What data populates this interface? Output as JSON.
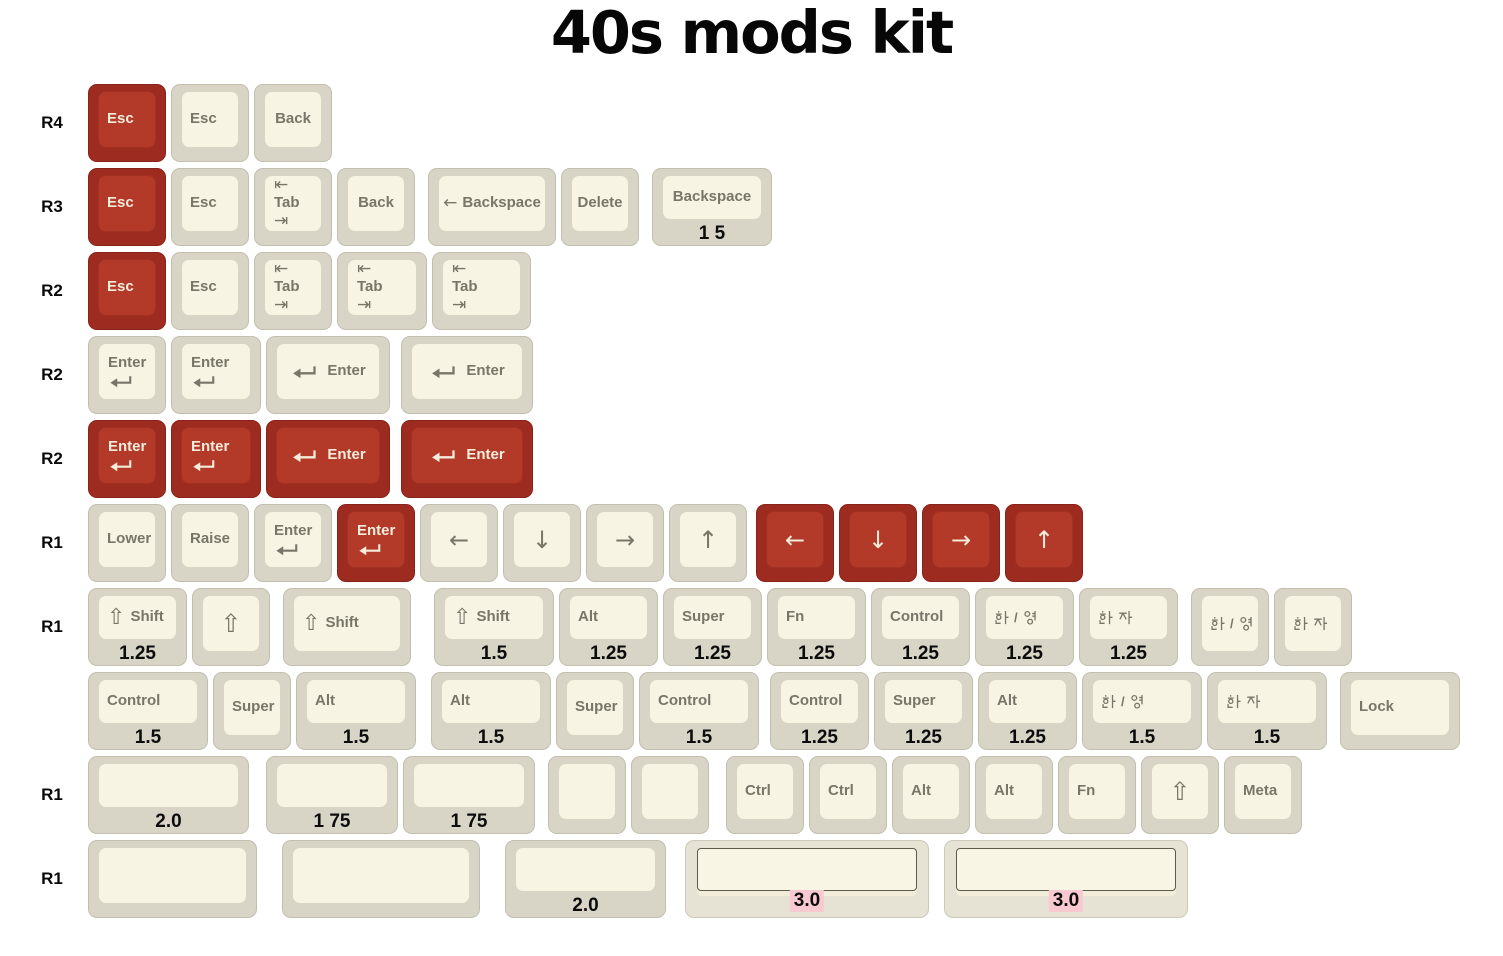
{
  "title": "40s mods kit",
  "colors": {
    "red_base": "#9d2b20",
    "red_top": "#b33a29",
    "cream_base": "#d8d5c7",
    "cream_top": "#f8f4e3",
    "legend_grey": "#787669",
    "legend_cream": "#f5ecdb",
    "size_label_black": "#0c0c0c",
    "size_highlight_pink": "#f8c9d1"
  },
  "rows": [
    {
      "label": "R4",
      "keys": [
        {
          "kind": "text",
          "text": "Esc",
          "red": true
        },
        {
          "kind": "text",
          "text": "Esc"
        },
        {
          "kind": "text",
          "text": "Back",
          "center": true
        }
      ]
    },
    {
      "label": "R3",
      "keys": [
        {
          "kind": "text",
          "text": "Esc",
          "red": true
        },
        {
          "kind": "text",
          "text": "Esc"
        },
        {
          "kind": "tab",
          "text": "Tab"
        },
        {
          "kind": "text",
          "text": "Back",
          "center": true
        },
        {
          "kind": "bksp",
          "text": "Backspace",
          "w": 1.6,
          "gap": 8,
          "center": true
        },
        {
          "kind": "text",
          "text": "Delete",
          "center": true
        },
        {
          "kind": "text",
          "text": "Backspace",
          "w": 1.5,
          "gap": 8,
          "sub": "1 5",
          "center": true
        }
      ]
    },
    {
      "label": "R2",
      "keys": [
        {
          "kind": "text",
          "text": "Esc",
          "red": true
        },
        {
          "kind": "text",
          "text": "Esc"
        },
        {
          "kind": "tab",
          "text": "Tab"
        },
        {
          "kind": "tab",
          "text": "Tab",
          "w": 1.15
        },
        {
          "kind": "tab",
          "text": "Tab",
          "w": 1.25
        }
      ]
    },
    {
      "label": "R2",
      "keys": [
        {
          "kind": "enter-v",
          "text": "Enter"
        },
        {
          "kind": "enter-v",
          "text": "Enter",
          "w": 1.15
        },
        {
          "kind": "enter-h",
          "text": "Enter",
          "w": 1.55
        },
        {
          "kind": "enter-h",
          "text": "Enter",
          "w": 1.65,
          "gap": 6
        }
      ]
    },
    {
      "label": "R2",
      "keys": [
        {
          "kind": "enter-v",
          "text": "Enter",
          "red": true
        },
        {
          "kind": "enter-v",
          "text": "Enter",
          "red": true,
          "w": 1.15
        },
        {
          "kind": "enter-h",
          "text": "Enter",
          "red": true,
          "w": 1.55
        },
        {
          "kind": "enter-h",
          "text": "Enter",
          "red": true,
          "w": 1.65,
          "gap": 6
        }
      ]
    },
    {
      "label": "R1",
      "keys": [
        {
          "kind": "text",
          "text": "Lower"
        },
        {
          "kind": "text",
          "text": "Raise"
        },
        {
          "kind": "enter-v",
          "text": "Enter"
        },
        {
          "kind": "enter-v",
          "text": "Enter",
          "red": true
        },
        {
          "kind": "arrow",
          "icon": "arrow-left"
        },
        {
          "kind": "arrow",
          "icon": "arrow-down"
        },
        {
          "kind": "arrow",
          "icon": "arrow-right"
        },
        {
          "kind": "arrow",
          "icon": "arrow-up"
        },
        {
          "kind": "arrow",
          "icon": "arrow-left",
          "red": true,
          "gap": 4
        },
        {
          "kind": "arrow",
          "icon": "arrow-down",
          "red": true
        },
        {
          "kind": "arrow",
          "icon": "arrow-right",
          "red": true
        },
        {
          "kind": "arrow",
          "icon": "arrow-up",
          "red": true
        }
      ]
    },
    {
      "label": "R1",
      "keys": [
        {
          "kind": "shift-text",
          "text": "Shift",
          "w": 1.25,
          "sub": "1.25"
        },
        {
          "kind": "shift"
        },
        {
          "kind": "shift-text",
          "text": "Shift",
          "w": 1.6,
          "gap": 8
        },
        {
          "kind": "shift-text",
          "text": "Shift",
          "w": 1.5,
          "gap": 18,
          "sub": "1.5"
        },
        {
          "kind": "text",
          "text": "Alt",
          "w": 1.25,
          "sub": "1.25"
        },
        {
          "kind": "text",
          "text": "Super",
          "w": 1.25,
          "sub": "1.25"
        },
        {
          "kind": "text",
          "text": "Fn",
          "w": 1.25,
          "sub": "1.25"
        },
        {
          "kind": "text",
          "text": "Control",
          "w": 1.25,
          "sub": "1.25"
        },
        {
          "kind": "hangul",
          "text": "한/영",
          "w": 1.25,
          "sub": "1.25"
        },
        {
          "kind": "hangul",
          "text": "한자",
          "w": 1.25,
          "sub": "1.25"
        },
        {
          "kind": "hangul",
          "text": "한/영",
          "gap": 8
        },
        {
          "kind": "hangul",
          "text": "한자"
        }
      ]
    },
    {
      "label": "",
      "keys": [
        {
          "kind": "text",
          "text": "Control",
          "w": 1.5,
          "sub": "1.5"
        },
        {
          "kind": "text",
          "text": "Super"
        },
        {
          "kind": "text",
          "text": "Alt",
          "w": 1.5,
          "sub": "1.5"
        },
        {
          "kind": "text",
          "text": "Alt",
          "w": 1.5,
          "gap": 10,
          "sub": "1.5"
        },
        {
          "kind": "text",
          "text": "Super"
        },
        {
          "kind": "text",
          "text": "Control",
          "w": 1.5,
          "sub": "1.5"
        },
        {
          "kind": "text",
          "text": "Control",
          "w": 1.25,
          "gap": 6,
          "sub": "1.25"
        },
        {
          "kind": "text",
          "text": "Super",
          "w": 1.25,
          "sub": "1.25"
        },
        {
          "kind": "text",
          "text": "Alt",
          "w": 1.25,
          "sub": "1.25"
        },
        {
          "kind": "hangul",
          "text": "한/영",
          "w": 1.5,
          "sub": "1.5"
        },
        {
          "kind": "hangul",
          "text": "한자",
          "w": 1.5,
          "sub": "1.5"
        },
        {
          "kind": "text",
          "text": "Lock",
          "w": 1.5,
          "gap": 8
        }
      ]
    },
    {
      "label": "R1",
      "keys": [
        {
          "kind": "blank",
          "w": 2,
          "sub": "2.0"
        },
        {
          "kind": "blank",
          "w": 1.65,
          "gap": 12,
          "sub": "1 75"
        },
        {
          "kind": "blank",
          "w": 1.65,
          "sub": "1 75"
        },
        {
          "kind": "blank",
          "gap": 8
        },
        {
          "kind": "blank"
        },
        {
          "kind": "text",
          "text": "Ctrl",
          "gap": 12
        },
        {
          "kind": "text",
          "text": "Ctrl"
        },
        {
          "kind": "text",
          "text": "Alt"
        },
        {
          "kind": "text",
          "text": "Alt"
        },
        {
          "kind": "text",
          "text": "Fn"
        },
        {
          "kind": "shift"
        },
        {
          "kind": "text",
          "text": "Meta"
        }
      ]
    },
    {
      "label": "R1",
      "keys": [
        {
          "kind": "blank",
          "w": 2.1
        },
        {
          "kind": "blank",
          "w": 2.45,
          "gap": 20
        },
        {
          "kind": "blank",
          "w": 2,
          "gap": 20,
          "sub": "2.0"
        },
        {
          "kind": "space",
          "w": 3,
          "gap": 14,
          "sub": "3.0",
          "pink": true
        },
        {
          "kind": "space",
          "w": 3,
          "gap": 10,
          "sub": "3.0",
          "pink": true
        }
      ]
    }
  ]
}
